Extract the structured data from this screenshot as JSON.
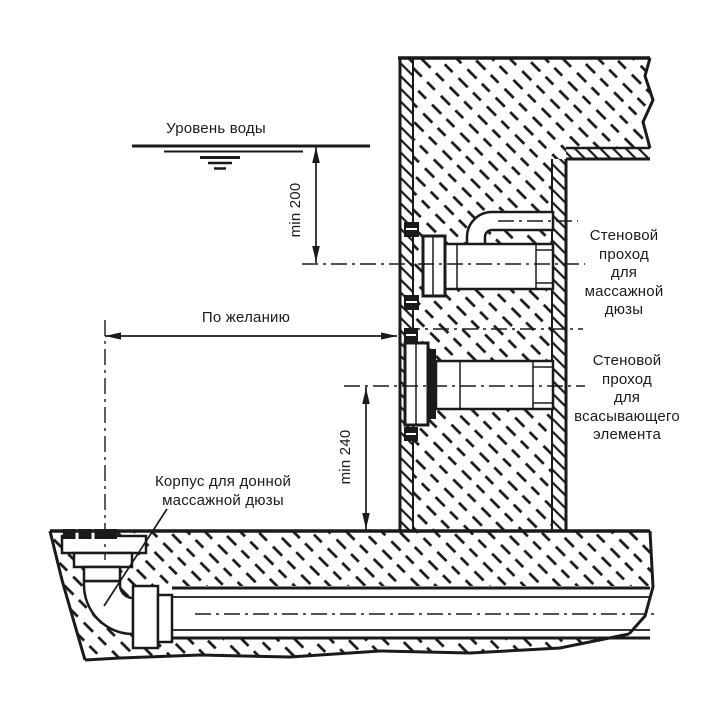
{
  "diagram": {
    "type": "technical-section-drawing",
    "subject": "pool-wall-and-floor-fittings-installation",
    "labels": {
      "water_level": "Уровень воды",
      "optional_distance": "По желанию",
      "bottom_nozzle_housing": [
        "Корпус для донной",
        "массажной дюзы"
      ],
      "wall_pass_massage": [
        "Стеновой",
        "проход",
        "для",
        "массажной",
        "дюзы"
      ],
      "wall_pass_suction": [
        "Стеновой",
        "проход",
        "для",
        "всасывающего",
        "элемента"
      ]
    },
    "dimensions": {
      "water_to_massage_nozzle": "min 200",
      "suction_to_floor": "min 240"
    },
    "colors": {
      "line": "#1a1a1a",
      "background": "#ffffff"
    }
  }
}
